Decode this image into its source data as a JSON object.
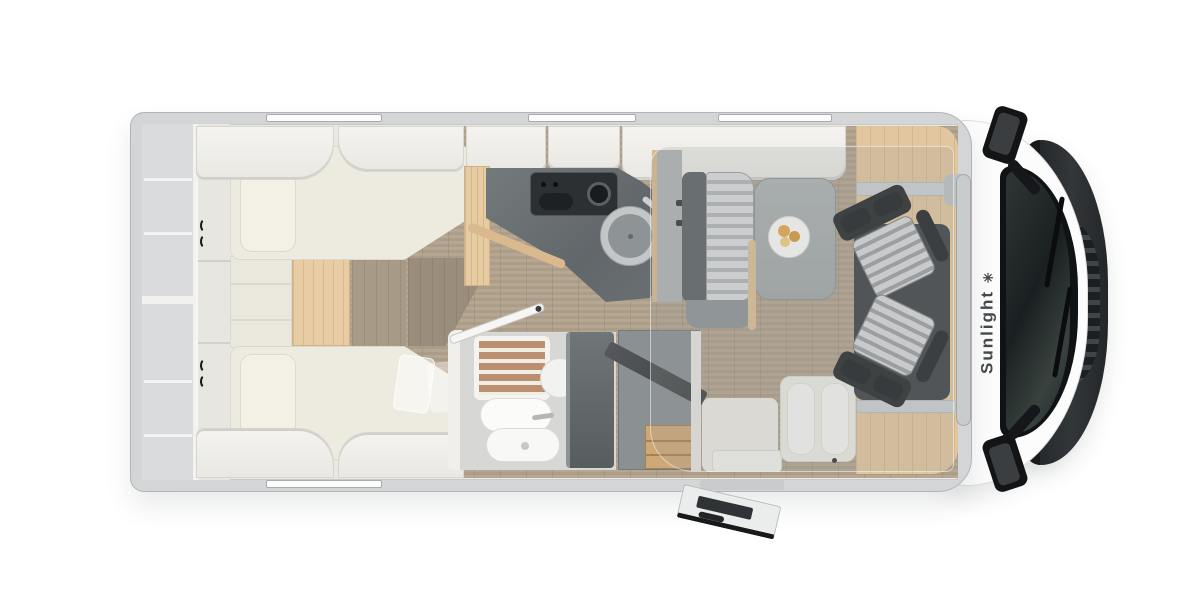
{
  "brand": {
    "name": "Sunlight",
    "logo_glyph": "✳"
  },
  "colors": {
    "page_bg": "#ffffff",
    "wall": "#d3d5d7",
    "wall_edge": "#b2b4b6",
    "interior": "#e9e8e4",
    "furniture_white": "#f1f0ec",
    "mattress": "#edeadf",
    "wood_floor": "#b2a28c",
    "wood_step": "#e8cda4",
    "wood_cab": "#e2c79e",
    "wood_trim": "#dab98e",
    "drawer_wood": "#cfa876",
    "counter": "#6b7173",
    "hob": "#2c3032",
    "partition": "#5f6567",
    "bench_gray": "#8f9496",
    "stripe_light": "#dadcdd",
    "stripe_dark": "#b3b7b9",
    "seat_dark": "#2b2e30",
    "table": "#a8adad",
    "glass": "#141719",
    "hood": "#26292b",
    "mirror": "#121416",
    "brand_text": "#45484b",
    "overlay": "rgba(150,155,156,0.22)",
    "plate_food": "#e3aa4e"
  },
  "floorplan": {
    "view": "top-down-motorhome-floor-plan",
    "areas": [
      {
        "name": "rear-twin-beds"
      },
      {
        "name": "kitchen"
      },
      {
        "name": "bathroom"
      },
      {
        "name": "wardrobe"
      },
      {
        "name": "dinette"
      },
      {
        "name": "entry-door"
      },
      {
        "name": "cab-swivel-seats"
      },
      {
        "name": "cab-front"
      }
    ]
  }
}
